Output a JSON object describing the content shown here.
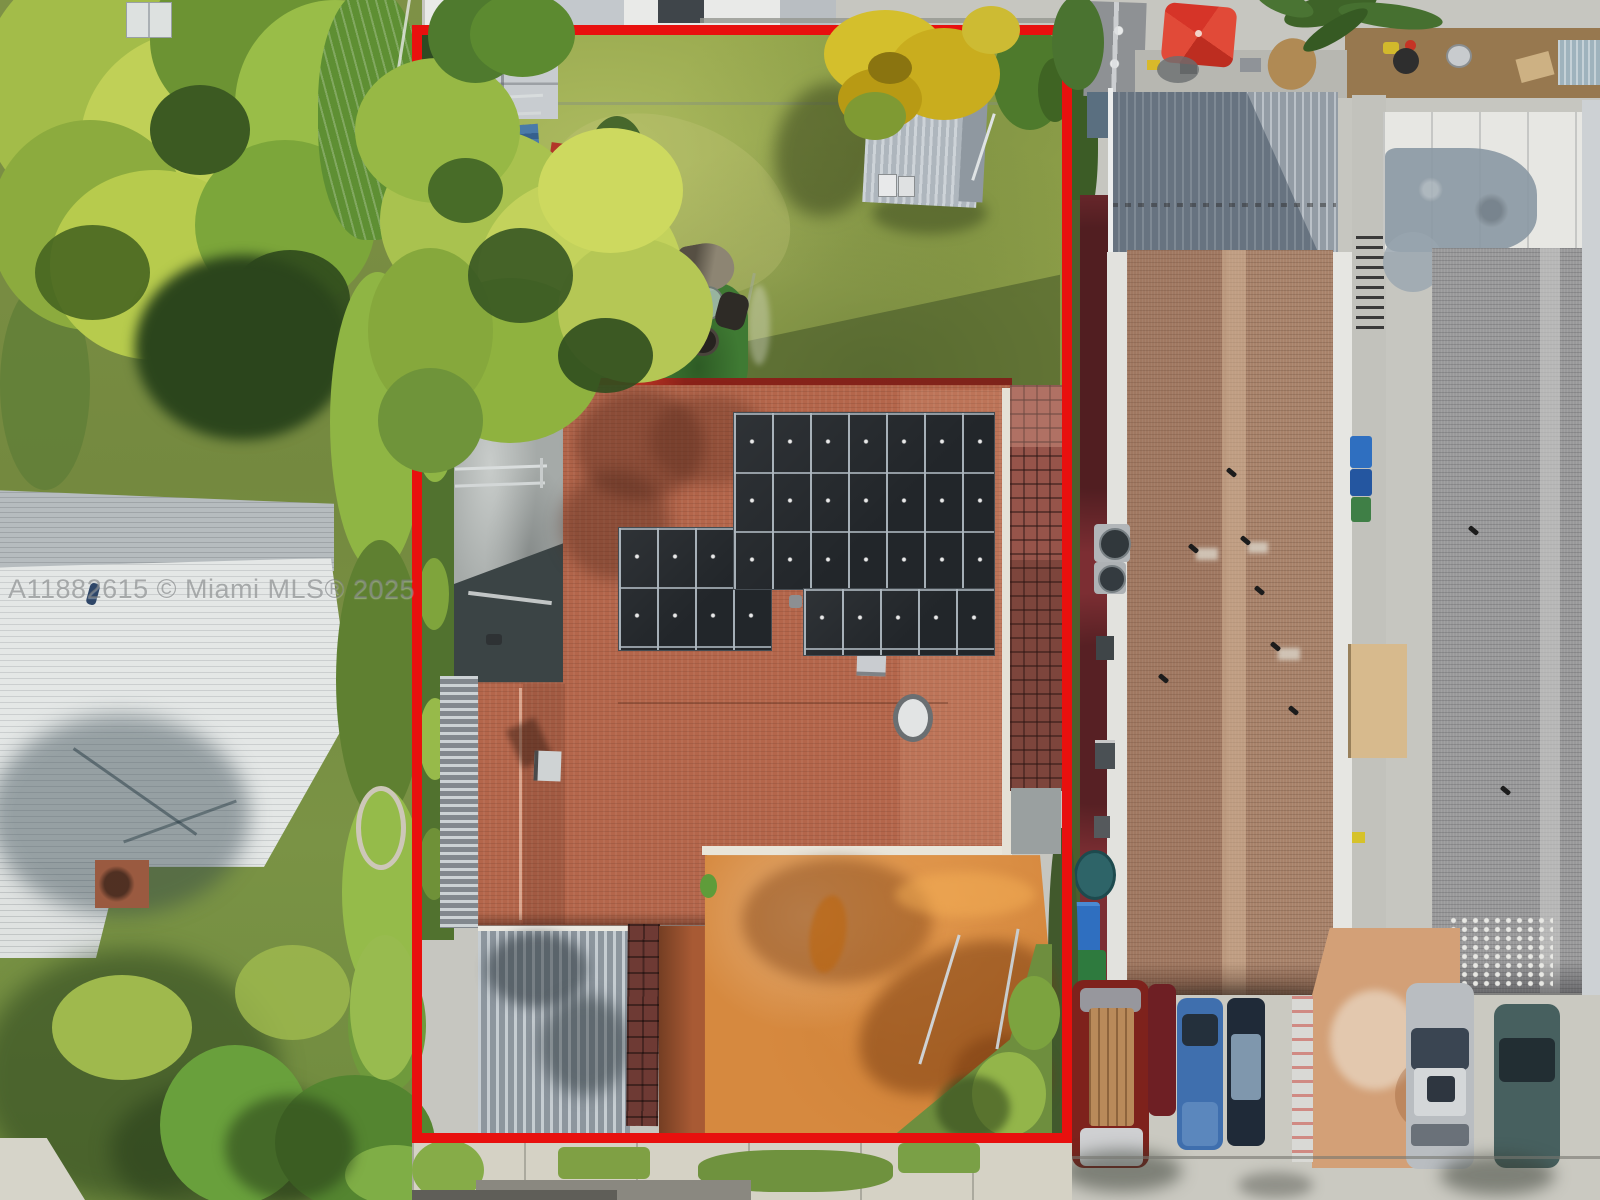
{
  "watermark": {
    "text": "A11882615 © Miami MLS® 2025"
  },
  "colors": {
    "boundaryRed": "#e8100e",
    "roofTerracotta": "#b4664b",
    "solarPanel": "#22262a",
    "yardGrass": "#96a74c",
    "drivewayOrange": "#d6893f",
    "umbrellaRed": "#d63428",
    "neighborRoof": "#e4e7e6",
    "brownShingle": "#a8826a",
    "grayShingle": "#99999a",
    "maroonGround": "#7c2e33",
    "concrete": "#c6c6c0"
  }
}
